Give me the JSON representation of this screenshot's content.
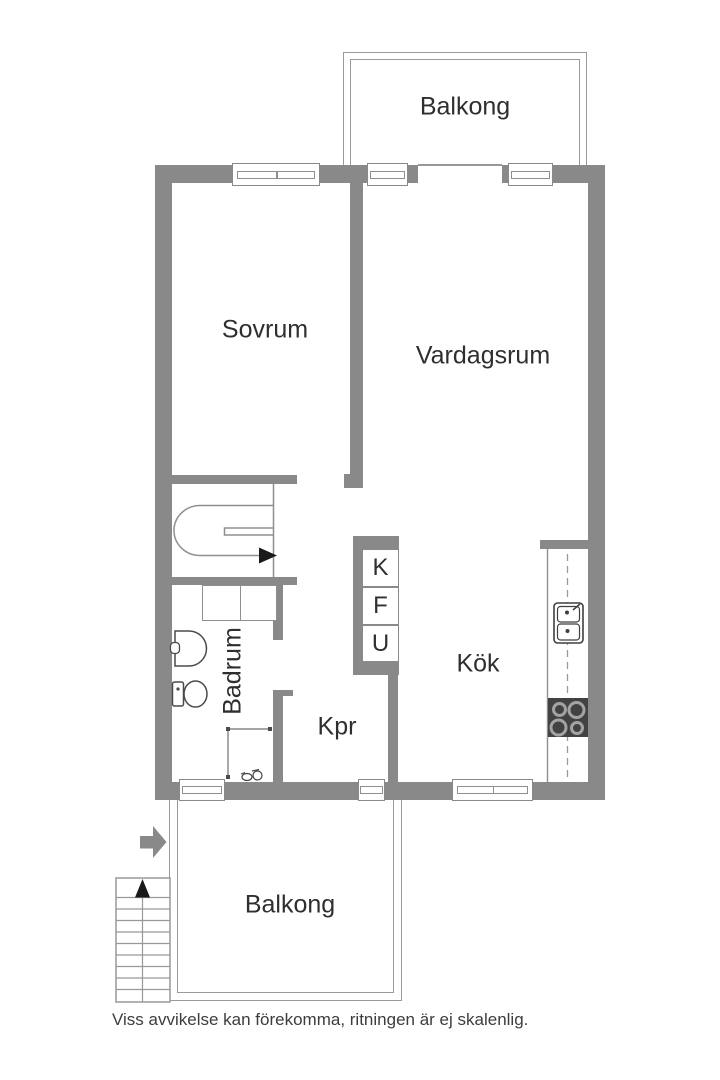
{
  "labels": {
    "balcony_top": "Balkong",
    "bedroom": "Sovrum",
    "living_room": "Vardagsrum",
    "bathroom": "Badrum",
    "closet": "Kpr",
    "kitchen": "Kök",
    "cabinet_k": "K",
    "cabinet_f": "F",
    "cabinet_u": "U",
    "balcony_bottom": "Balkong",
    "disclaimer": "Viss avvikelse kan förekomma, ritningen är ej skalenlig."
  },
  "icons": {
    "entry_arrow": "thick-right-arrow",
    "stairs_direction_arrow": "right-arrow",
    "external_stairs_arrow": "up-arrow",
    "internal_stairs": "u-turn-staircase",
    "external_stairs": "straight-staircase",
    "toilet": "toilet-top-view",
    "bathroom_sink": "washbasin-top-view",
    "shower_screen": "thin-line-with-end-dots",
    "floor_drain": "small-fitting-glyph",
    "kitchen_sink": "double-bowl-sink",
    "stove": "four-burner-cooktop",
    "kitchen_counter": "dashed-centerline-counter",
    "bathroom_cabinet": "two-section-closet"
  },
  "colors": {
    "wall": "#898989",
    "thin_outline": "#999999",
    "fixture_outline": "#4a4a4a",
    "stove_body": "#424242",
    "burner_ring": "#a3a3a3",
    "text": "#2f2f2f",
    "arrow_black": "#1a1a1a"
  }
}
